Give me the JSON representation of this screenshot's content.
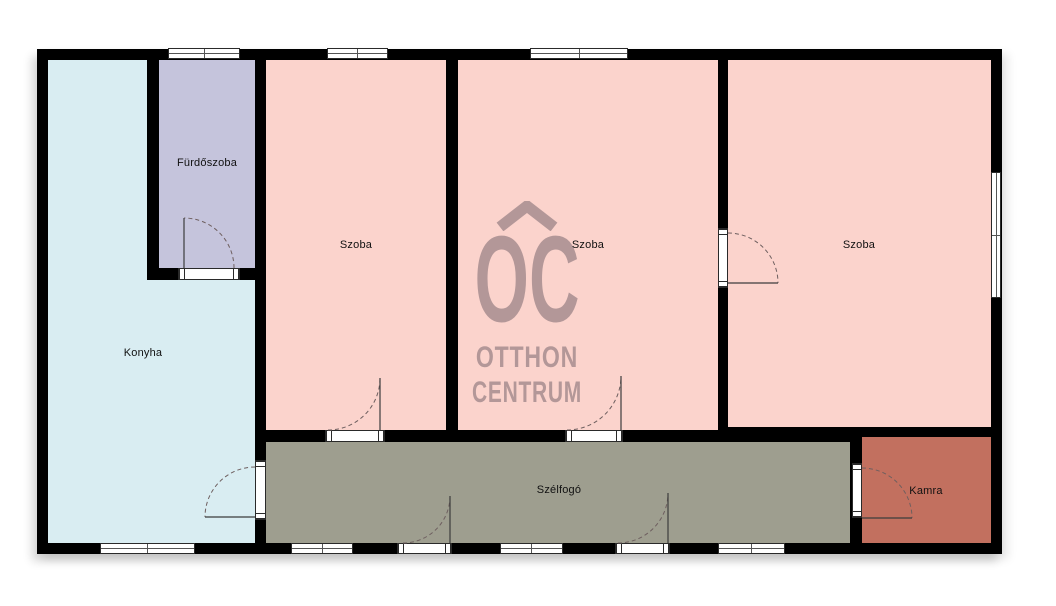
{
  "brand": {
    "monogram": "OC",
    "name_line1": "OTTHON",
    "name_line2": "CENTRUM"
  },
  "rooms": [
    {
      "label": "Fürdőszoba"
    },
    {
      "label": "Konyha"
    },
    {
      "label": "Szoba"
    },
    {
      "label": "Szoba"
    },
    {
      "label": "Szoba"
    },
    {
      "label": "Szélfogó"
    },
    {
      "label": "Kamra"
    }
  ],
  "colors": {
    "wall": "#000000",
    "furdoszoba": "#c5c4dc",
    "konyha": "#d9edf2",
    "szoba": "#fbd3cc",
    "szelfogo": "#9e9e8f",
    "kamra": "#c2705f",
    "watermark": "#b39798",
    "background": "#ffffff"
  }
}
